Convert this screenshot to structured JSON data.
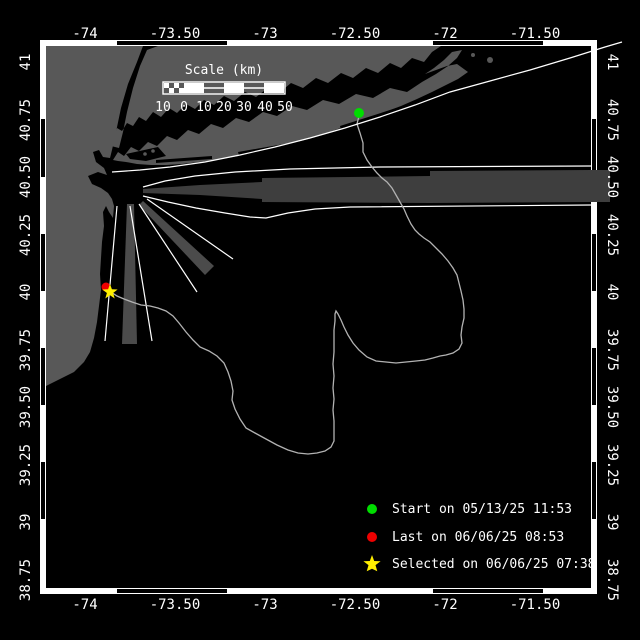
{
  "map": {
    "axis": {
      "lon": [
        "-74",
        "-73.50",
        "-73",
        "-72.50",
        "-72",
        "-71.50"
      ],
      "lat": [
        "41",
        "40.75",
        "40.50",
        "40.25",
        "40",
        "39.75",
        "39.50",
        "39.25",
        "39",
        "38.75"
      ]
    },
    "scale_bar": {
      "title": "Scale (km)",
      "ticks": [
        "10",
        "0",
        "10",
        "20",
        "30",
        "40",
        "50"
      ]
    },
    "legend": {
      "items": [
        {
          "icon": "green-dot",
          "color": "#00dd00",
          "label": "Start on 05/13/25 11:53"
        },
        {
          "icon": "red-dot",
          "color": "#ee0000",
          "label": "Last on 06/06/25 08:53"
        },
        {
          "icon": "yellow-star",
          "color": "#ffee00",
          "label": "Selected on 06/06/25 07:38"
        }
      ]
    },
    "markers": {
      "start": {
        "color": "#00dd00"
      },
      "last": {
        "color": "#ee0000"
      },
      "selected": {
        "color": "#ffee00"
      }
    },
    "colors": {
      "water": "#000000",
      "land": "#585858",
      "shipping_lane": "#3e3e3e",
      "lane_zone": "#4b4b4b",
      "track": "#b2b2b2",
      "frame": "#ffffff"
    }
  }
}
